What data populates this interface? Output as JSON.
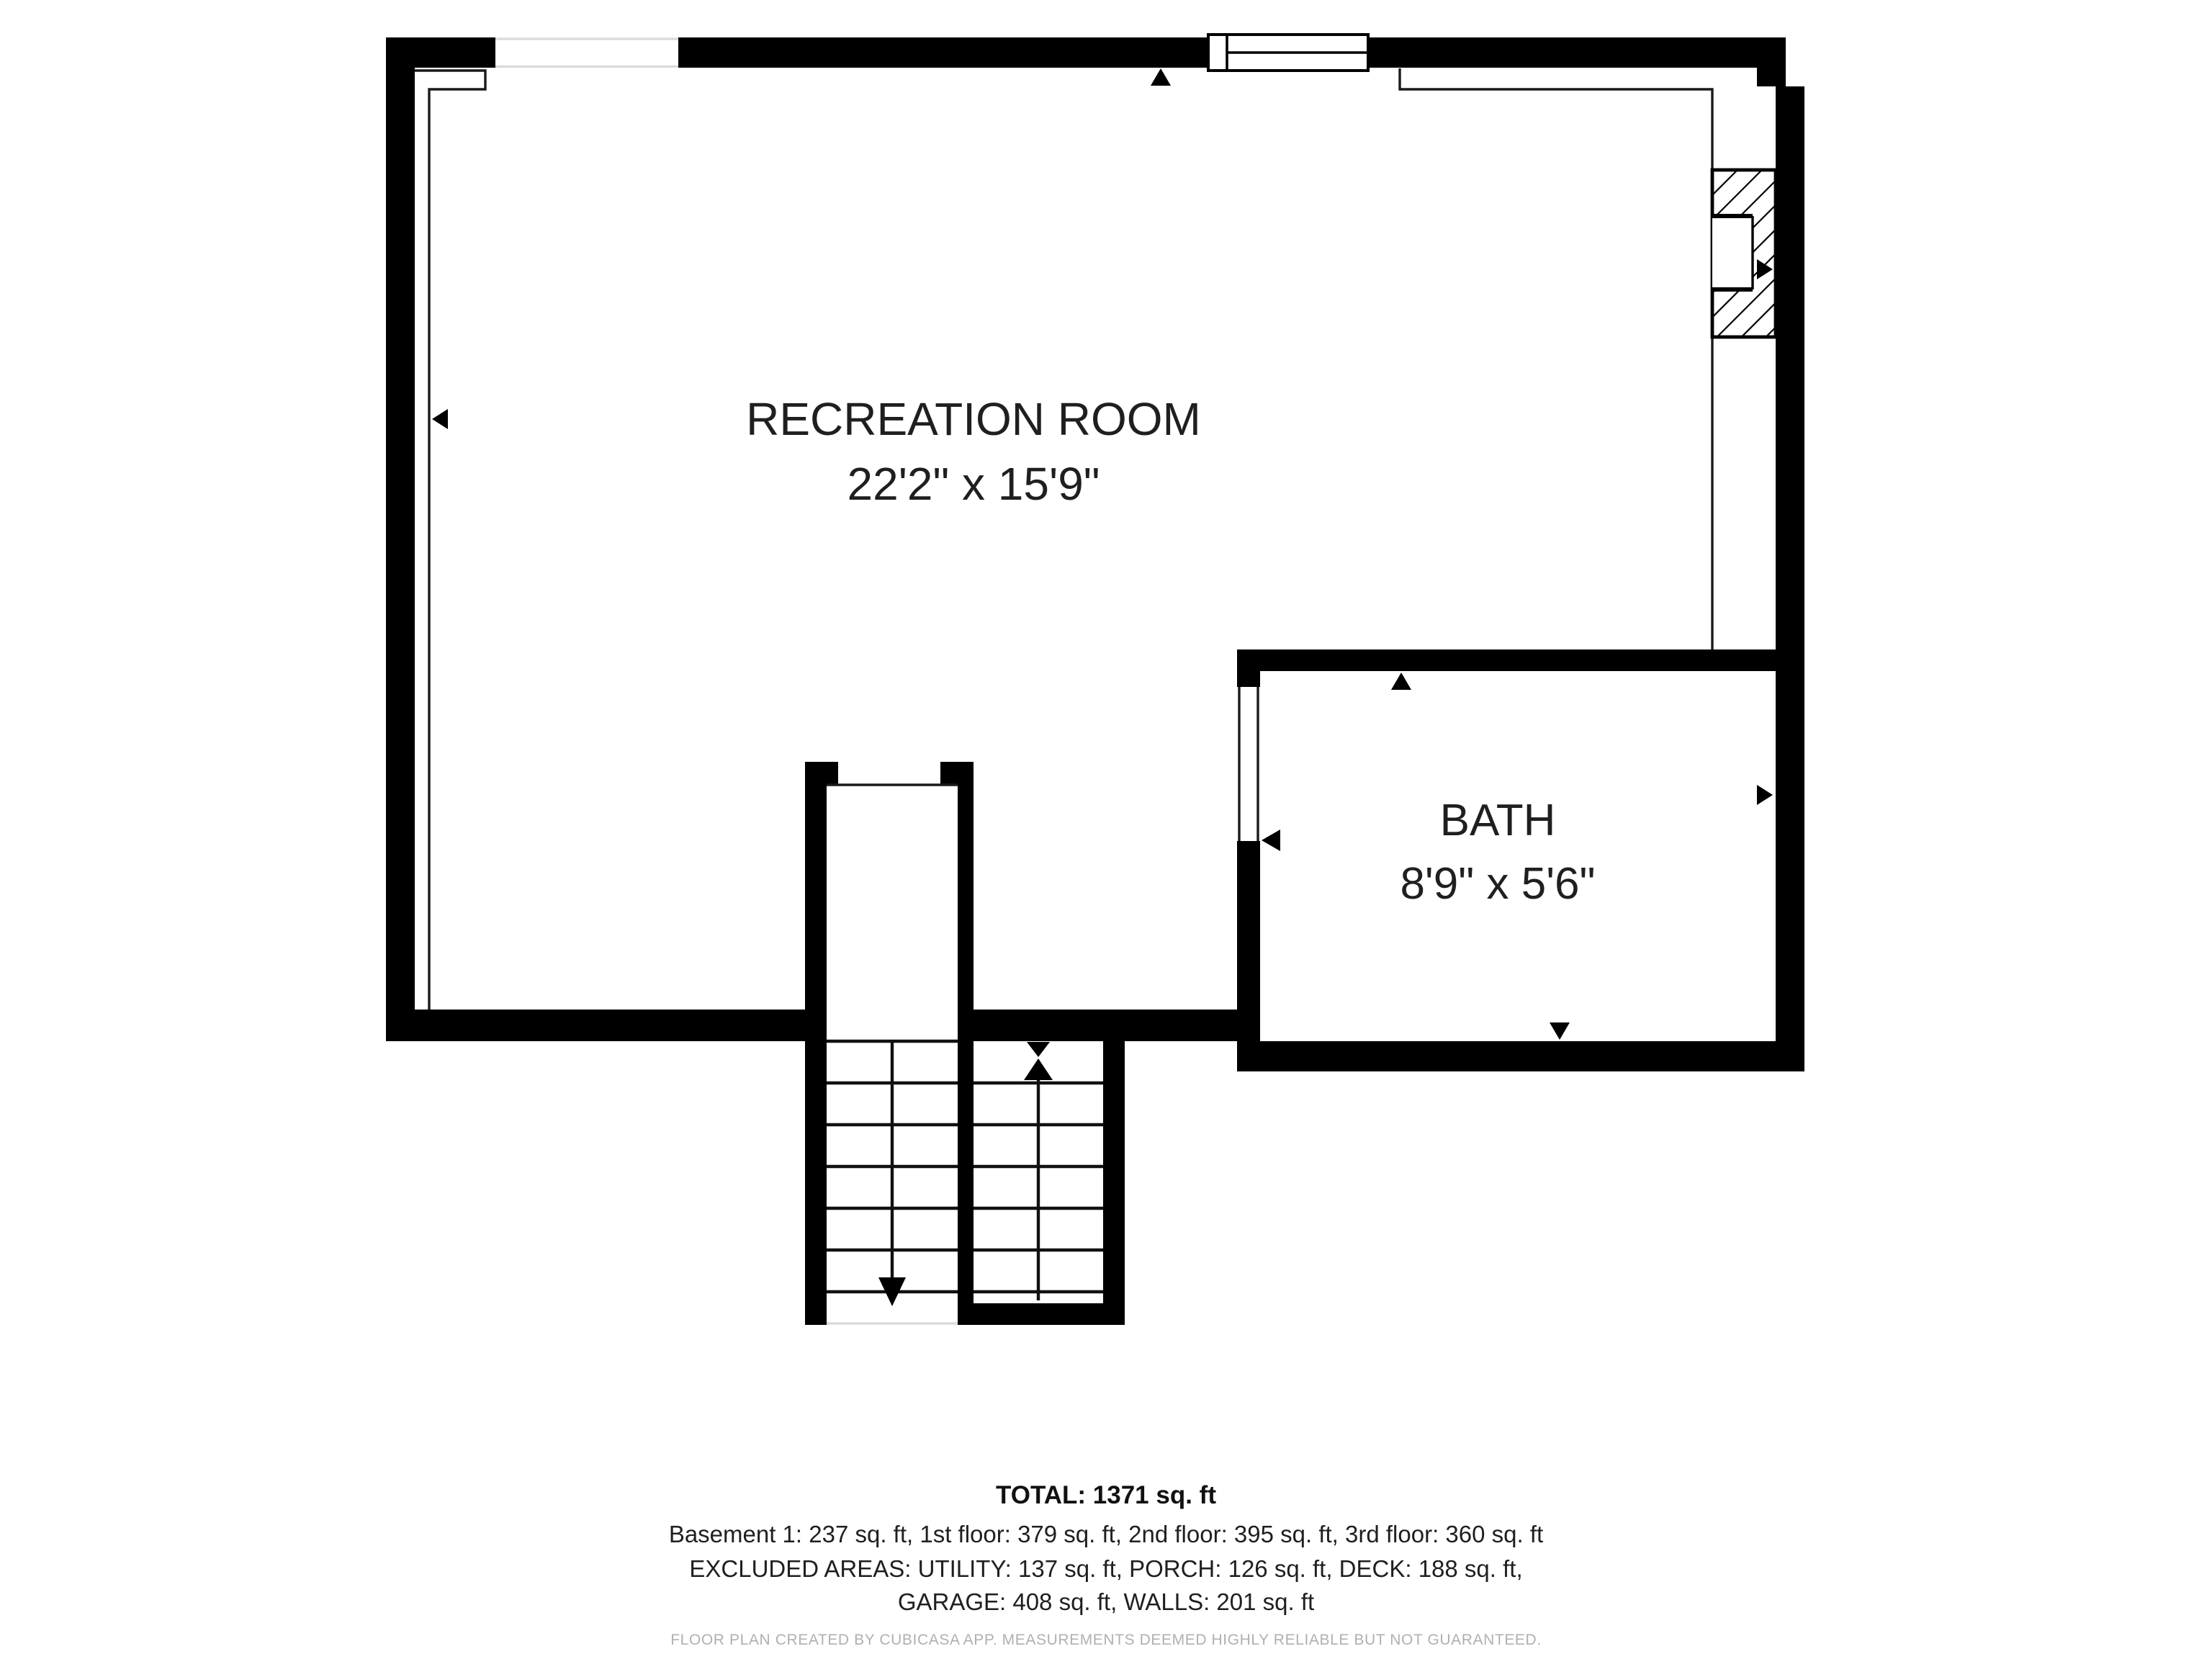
{
  "floor_plan": {
    "rooms": [
      {
        "name": "RECREATION ROOM",
        "dimensions": "22'2\" x 15'9\""
      },
      {
        "name": "BATH",
        "dimensions": "8'9\" x 5'6\""
      }
    ],
    "stairs": {
      "down_run_direction": "down",
      "up_run_direction": "up"
    },
    "summary": {
      "total": "TOTAL: 1371 sq. ft",
      "floors": "Basement 1: 237 sq. ft, 1st floor: 379 sq. ft, 2nd floor: 395 sq. ft, 3rd floor: 360 sq. ft",
      "excluded_line1": "EXCLUDED AREAS: UTILITY: 137 sq. ft, PORCH: 126 sq. ft, DECK: 188 sq. ft,",
      "excluded_line2": "GARAGE: 408 sq. ft, WALLS: 201 sq. ft"
    },
    "footer": "FLOOR PLAN CREATED BY CUBICASA APP. MEASUREMENTS DEEMED HIGHLY RELIABLE BUT NOT GUARANTEED.",
    "colors": {
      "wall": "#000000",
      "text": "#1f1f1f",
      "muted_text": "#b0b0b0",
      "background": "#ffffff"
    }
  }
}
